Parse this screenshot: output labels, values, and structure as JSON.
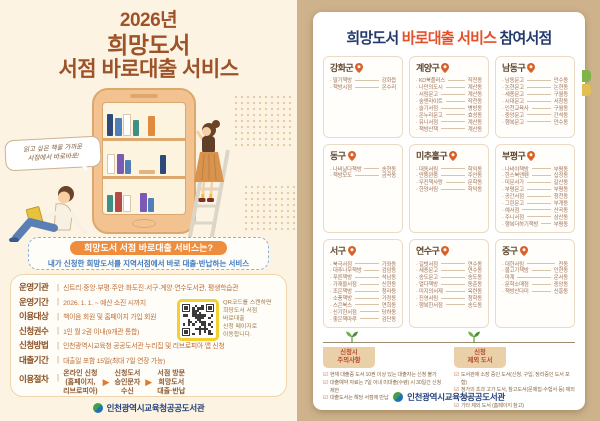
{
  "colors": {
    "page_bg": "#cdb28b",
    "left_bg": "#fcf3e2",
    "title_brown": "#9d5228",
    "pill_orange": "#ee8d3e",
    "desc_blue": "#3c79c0",
    "navy": "#243a6b",
    "orange": "#e3512a",
    "qr_yellow": "#f2d12e",
    "footer_navy": "#26427c"
  },
  "left_poster": {
    "title": {
      "year": "2026년",
      "line2": "희망도서",
      "line3": "서점 바로대출 서비스"
    },
    "speech_bubble": {
      "line1": "읽고 싶은 책을 가까운",
      "line2": "서점에서 바로바로!"
    },
    "intro": {
      "pill": "희망도서 서점 바로대출 서비스는?",
      "desc": "내가 신청한 희망도서를 지역서점에서 바로 대출·반납하는 서비스"
    },
    "info_rows": [
      {
        "label": "운영기관",
        "value": "신트리·중앙·부평·주안·화도진·서구·계양·연수도서관, 평생학습관"
      },
      {
        "label": "운영기간",
        "value": "2026. 1. 1. ~ 예산 소진 시까지"
      },
      {
        "label": "이용대상",
        "value": "책이음 회원 및 홈페이지 가입 회원"
      },
      {
        "label": "신청권수",
        "value": "1인 월 2권 이내(9개관 통합)"
      },
      {
        "label": "신청방법",
        "value": "인천광역시교육청 공공도서관 누리집 및 리브로피아 앱 신청"
      },
      {
        "label": "대출기간",
        "value": "대출일 포함 15일(최대 7일 연장 가능)"
      }
    ],
    "procedure": {
      "label": "이용절차",
      "steps": [
        "온라인 신청\n(홈페이지,\n리브로피아)",
        "신청도서\n승인문자\n수신",
        "서점 방문\n희망도서\n대출·반납"
      ]
    },
    "qr_caption": "QR코드를 스캔하면\n희망도서 서점\n바로대출\n신청 페이지로\n이동합니다.",
    "footer": "인천광역시교육청공공도서관"
  },
  "right_poster": {
    "title_parts": [
      {
        "text": "희망도서 ",
        "color": "#243a6b"
      },
      {
        "text": "바로대출 ",
        "color": "#e3512a"
      },
      {
        "text": "서비스 ",
        "color": "#e3512a"
      },
      {
        "text": "참여서점",
        "color": "#243a6b"
      }
    ],
    "districts": [
      {
        "name": "강화군",
        "stores": [
          [
            "딸기책방",
            "강화읍"
          ],
          [
            "책방시점",
            "온수리"
          ]
        ]
      },
      {
        "name": "계양구",
        "stores": [
          [
            "KD북플러스",
            "작전동"
          ],
          [
            "나만의도시",
            "계산동"
          ],
          [
            "서림문고",
            "계산동"
          ],
          [
            "숲앤라이트",
            "작전동"
          ],
          [
            "슬기서점",
            "병방동"
          ],
          [
            "온누리문고",
            "효성동"
          ],
          [
            "유니서점",
            "계산동"
          ],
          [
            "책방산책",
            "계산동"
          ]
        ]
      },
      {
        "name": "남동구",
        "stores": [
          [
            "남동문고",
            "만수동"
          ],
          [
            "논현문고",
            "논현동"
          ],
          [
            "세종문고",
            "구월동"
          ],
          [
            "시대문고",
            "서창동"
          ],
          [
            "인천교육사",
            "구월동"
          ],
          [
            "중앙문고",
            "간석동"
          ],
          [
            "행복문고",
            "만수동"
          ]
        ]
      },
      {
        "name": "동구",
        "stores": [
          [
            "나비날다책방",
            "송현동"
          ],
          [
            "책방모도",
            "금곡동"
          ]
        ]
      },
      {
        "name": "미추홀구",
        "stores": [
          [
            "대동서림",
            "학익동"
          ],
          [
            "딴뚬꽌뚬",
            "주안동"
          ],
          [
            "우진책사랑",
            "문학동"
          ],
          [
            "한양서림",
            "학익동"
          ]
        ]
      },
      {
        "name": "부평구",
        "stores": [
          [
            "나비야책방",
            "부평동"
          ],
          [
            "한스북앤펜",
            "십정동"
          ],
          [
            "미문서가",
            "갈산동"
          ],
          [
            "부평문고",
            "부평동"
          ],
          [
            "공간서점",
            "청천동"
          ],
          [
            "그린문고",
            "부개동"
          ],
          [
            "예서점",
            "산곡동"
          ],
          [
            "주니서점",
            "삼산동"
          ],
          [
            "행복더하기책방",
            "부평동"
          ]
        ]
      },
      {
        "name": "서구",
        "stores": [
          [
            "북극서점",
            "가좌동"
          ],
          [
            "대추나무책방",
            "검암동"
          ],
          [
            "푸른책방",
            "석남동"
          ],
          [
            "가재울서점",
            "신현동"
          ],
          [
            "조은책방",
            "청라동"
          ],
          [
            "소풍책방",
            "가정동"
          ],
          [
            "스콘북스",
            "연희동"
          ],
          [
            "신기한서점",
            "당하동"
          ],
          [
            "좋은책마루",
            "검단동"
          ]
        ]
      },
      {
        "name": "연수구",
        "stores": [
          [
            "길벗서점",
            "연수동"
          ],
          [
            "세종문고",
            "연수동"
          ],
          [
            "송도문고",
            "송도동"
          ],
          [
            "열다책방",
            "동춘동"
          ],
          [
            "미지의서재",
            "옥련동"
          ],
          [
            "진영서림",
            "청학동"
          ],
          [
            "행복한서점",
            "송도동"
          ]
        ]
      },
      {
        "name": "중구",
        "stores": [
          [
            "대한서림",
            "전동"
          ],
          [
            "물고기책방",
            "인현동"
          ],
          [
            "마계",
            "운서동"
          ],
          [
            "문학소매점",
            "중앙동"
          ],
          [
            "책방산다미",
            "신흥동"
          ]
        ]
      }
    ],
    "notes": [
      {
        "title": "신청시\n주의사항",
        "items": [
          "현재 대출중 도서 10권 이상 있는 대출자는 신청 불가",
          "대출예약 자료는 7일 이내 미대출(수령) 시 30일간 신청 제한",
          "대출도서는 해당 서점에 반납"
        ]
      },
      {
        "title": "신청\n제외 도서",
        "items": [
          "도서관에 소장 중인 도서(신청, 구입, 정리중인 도서 포함)",
          "정가의 초과 고가 도서, 참고도서(문제집·수험서 등) 제외 도서",
          "기타 제외 도서 (홈페이지 참고)"
        ]
      }
    ],
    "footer": "인천광역시교육청공공도서관"
  }
}
